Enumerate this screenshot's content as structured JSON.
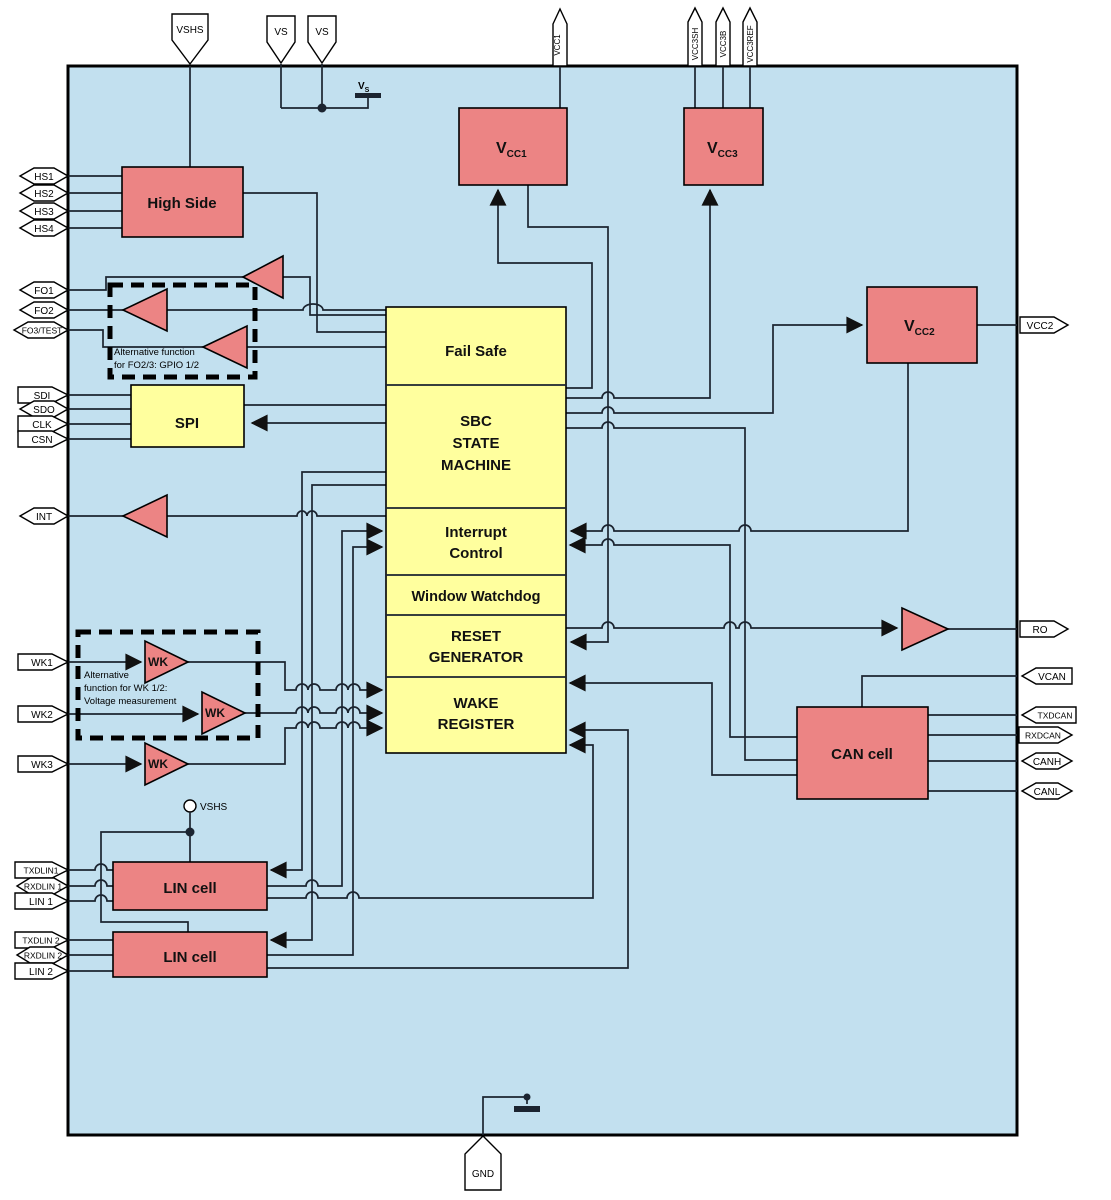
{
  "colors": {
    "chip_fill": "#C2E0EF",
    "block_red": "#EC8484",
    "block_yellow": "#FFFF9E",
    "wire": "#1B2430",
    "pin_fill": "#FFFFFF"
  },
  "blocks": {
    "high_side": "High Side",
    "spi": "SPI",
    "fail_safe": "Fail Safe",
    "sbc": {
      "l1": "SBC",
      "l2": "STATE",
      "l3": "MACHINE"
    },
    "interrupt": {
      "l1": "Interrupt",
      "l2": "Control"
    },
    "watchdog": "Window Watchdog",
    "reset": {
      "l1": "RESET",
      "l2": "GENERATOR"
    },
    "wake": {
      "l1": "WAKE",
      "l2": "REGISTER"
    },
    "can_cell": "CAN cell",
    "lin_cell": "LIN cell",
    "wk_buffer": "WK",
    "vcc1": {
      "v": "V",
      "sub": "CC1"
    },
    "vcc2": {
      "v": "V",
      "sub": "CC2"
    },
    "vcc3": {
      "v": "V",
      "sub": "CC3"
    }
  },
  "pins": {
    "top": {
      "vshs": "VSHS",
      "vs1": "VS",
      "vs2": "VS",
      "vcc1": "VCC1",
      "vcc3sh": "VCC3SH",
      "vcc3b": "VCC3B",
      "vcc3ref": "VCC3REF"
    },
    "left": {
      "hs1": "HS1",
      "hs2": "HS2",
      "hs3": "HS3",
      "hs4": "HS4",
      "fo1": "FO1",
      "fo2": "FO2",
      "fo3": "FO3/TEST",
      "sdi": "SDI",
      "sdo": "SDO",
      "clk": "CLK",
      "csn": "CSN",
      "int": "INT",
      "wk1": "WK1",
      "wk2": "WK2",
      "wk3": "WK3",
      "txdlin1": "TXDLIN1",
      "rxdlin1": "RXDLIN 1",
      "lin1": "LIN 1",
      "txdlin2": "TXDLIN 2",
      "rxdlin2": "RXDLIN 2",
      "lin2": "LIN 2"
    },
    "right": {
      "vcc2": "VCC2",
      "ro": "RO",
      "vcan": "VCAN",
      "txdcan": "TXDCAN",
      "rxdcan": "RXDCAN",
      "canh": "CANH",
      "canl": "CANL"
    },
    "bottom": {
      "gnd": "GND"
    }
  },
  "symbols": {
    "vs_supply": {
      "v": "V",
      "sub": "S"
    },
    "vshs_node": "VSHS"
  },
  "annotations": {
    "gpio_note": {
      "l1": "Alternative function",
      "l2": "for FO2/3: GPIO 1/2"
    },
    "wk_note": {
      "l1": "Alternative",
      "l2": "function for WK 1/2:",
      "l3": "Voltage measurement"
    }
  }
}
